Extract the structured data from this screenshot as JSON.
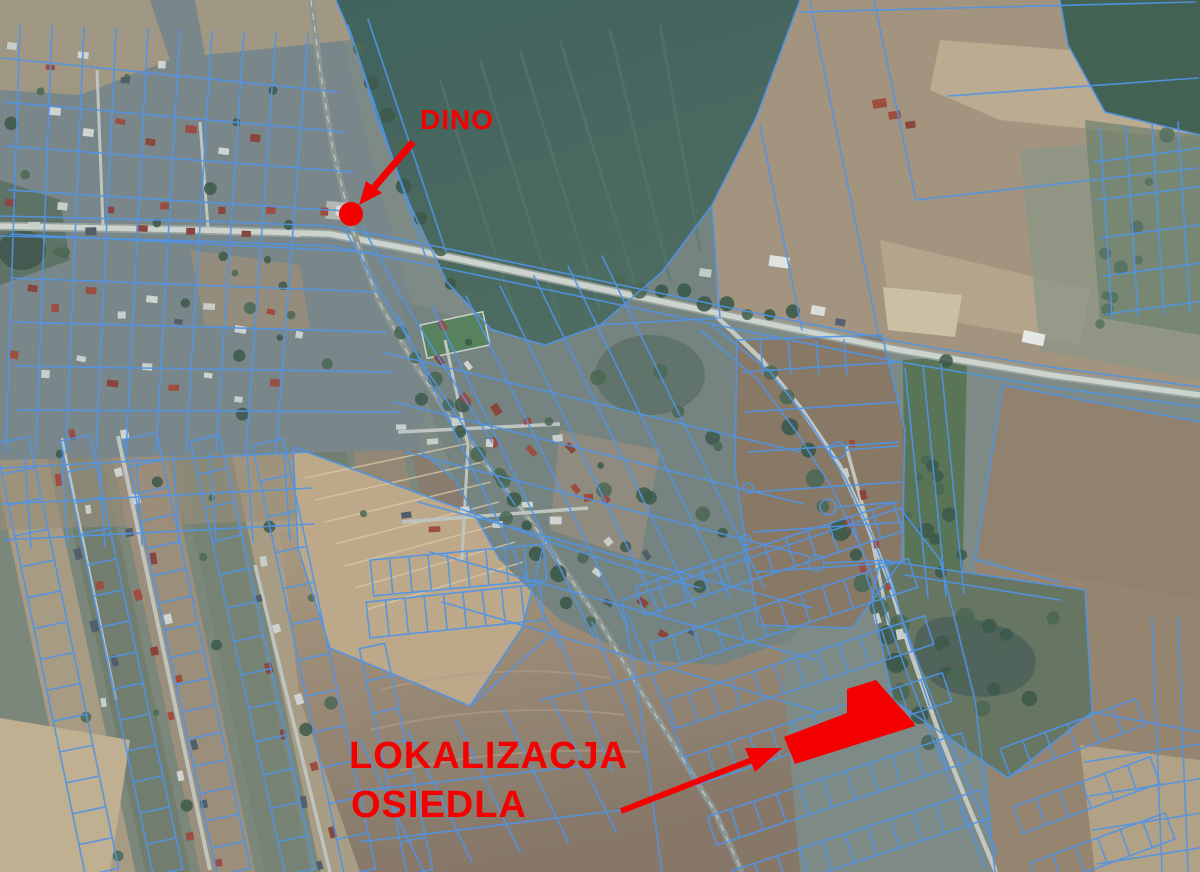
{
  "map": {
    "type": "aerial-orthophoto-cadastral",
    "colors": {
      "annotation_red": "#f40000",
      "parcel_blue": "#4e95e9"
    }
  },
  "annotations": {
    "dino": {
      "label": "DINO",
      "label_pos": {
        "x": 420,
        "y": 129
      },
      "arrow_d": "M413,142 L371,191",
      "arrowhead_points": "359,205 366,181 382,193",
      "dot": {
        "cx": 351,
        "cy": 214,
        "r": 12
      }
    },
    "site": {
      "label_line1": "LOKALIZACJA",
      "label_line2": "OSIEDLA",
      "label_pos": {
        "x": 349,
        "y1": 768,
        "x2": 351,
        "y2": 817
      },
      "arrow_d": "M621,811 L752,760",
      "arrowhead_points": "782,748 755,772 745,748",
      "polygon_points": "847,689 876,680 914,723 915,726 795,764 784,737 847,713"
    }
  }
}
